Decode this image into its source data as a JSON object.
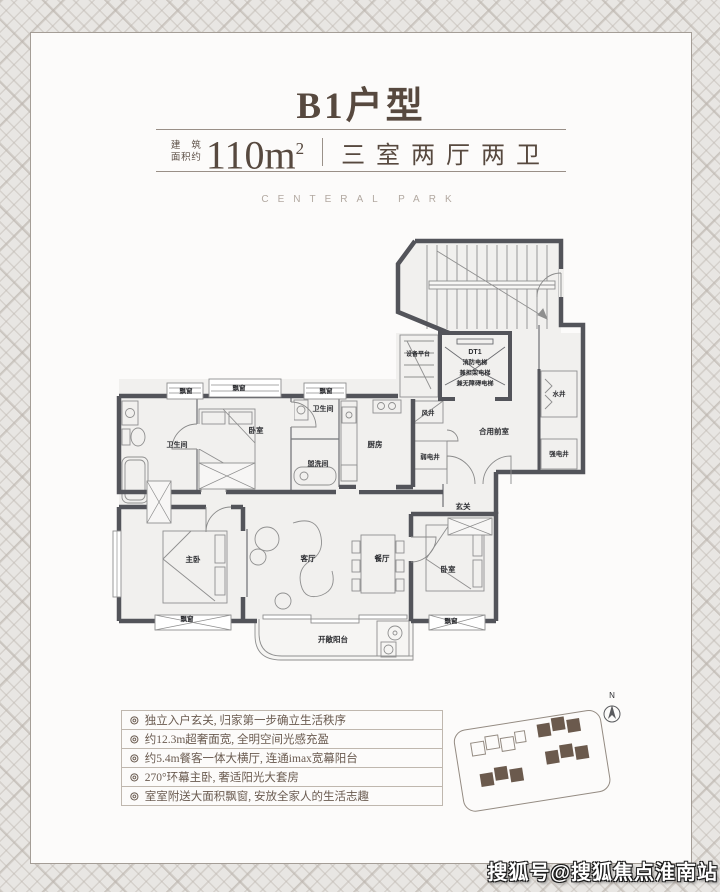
{
  "header": {
    "title": "B1户型",
    "area_label_top": "建筑",
    "area_label_bottom": "面积约",
    "area_value": "110m",
    "area_sup": "2",
    "layout_text": "三室两厅两卫",
    "brand": "CENTERAL PARK"
  },
  "floorplan": {
    "elevator_lines": [
      "DT1",
      "消防电梯",
      "兼担架电梯",
      "兼无障碍电梯"
    ],
    "rooms": [
      {
        "label": "设备平台",
        "x": 307,
        "y": 127,
        "s": 6
      },
      {
        "label": "水井",
        "x": 448,
        "y": 167,
        "s": 6.5
      },
      {
        "label": "合用前室",
        "x": 383,
        "y": 205,
        "s": 7.5
      },
      {
        "label": "强电井",
        "x": 448,
        "y": 227,
        "s": 6.5
      },
      {
        "label": "风井",
        "x": 317,
        "y": 186,
        "s": 6.5
      },
      {
        "label": "弱电井",
        "x": 319,
        "y": 230,
        "s": 6.5
      },
      {
        "label": "厨房",
        "x": 264,
        "y": 218,
        "s": 7.5
      },
      {
        "label": "卫生间",
        "x": 212,
        "y": 182,
        "s": 7
      },
      {
        "label": "盥洗间",
        "x": 207,
        "y": 237,
        "s": 7
      },
      {
        "label": "卧室",
        "x": 145,
        "y": 204,
        "s": 7.5
      },
      {
        "label": "卫生间",
        "x": 66,
        "y": 218,
        "s": 7
      },
      {
        "label": "飘窗",
        "x": 75,
        "y": 164,
        "s": 6.5
      },
      {
        "label": "飘窗",
        "x": 128,
        "y": 161,
        "s": 6.5
      },
      {
        "label": "飘窗",
        "x": 215,
        "y": 164,
        "s": 6.5
      },
      {
        "label": "玄关",
        "x": 352,
        "y": 280,
        "s": 7.5
      },
      {
        "label": "主卧",
        "x": 82,
        "y": 333,
        "s": 7.5
      },
      {
        "label": "客厅",
        "x": 197,
        "y": 332,
        "s": 7.5
      },
      {
        "label": "餐厅",
        "x": 271,
        "y": 332,
        "s": 7.5
      },
      {
        "label": "卧室",
        "x": 337,
        "y": 343,
        "s": 7.5
      },
      {
        "label": "飘窗",
        "x": 76,
        "y": 392,
        "s": 6.5
      },
      {
        "label": "飘窗",
        "x": 340,
        "y": 394,
        "s": 6.5
      },
      {
        "label": "开敞阳台",
        "x": 222,
        "y": 413,
        "s": 7.5
      }
    ]
  },
  "features": {
    "bullet": "◎",
    "items": [
      "独立入户玄关, 归家第一步确立生活秩序",
      "约12.3m超奢面宽, 全明空间光感充盈",
      "约5.4m餐客一体大横厅, 连通imax宽幕阳台",
      "270°环幕主卧, 奢适阳光大套房",
      "室室附送大面积飘窗, 安放全家人的生活志趣"
    ]
  },
  "sitemap": {
    "compass_label": "N"
  },
  "watermark": "搜狐号@搜狐焦点淮南站",
  "colors": {
    "accent": "#57493f",
    "wall": "#53545a",
    "building_fill": "#6b5a4d"
  }
}
